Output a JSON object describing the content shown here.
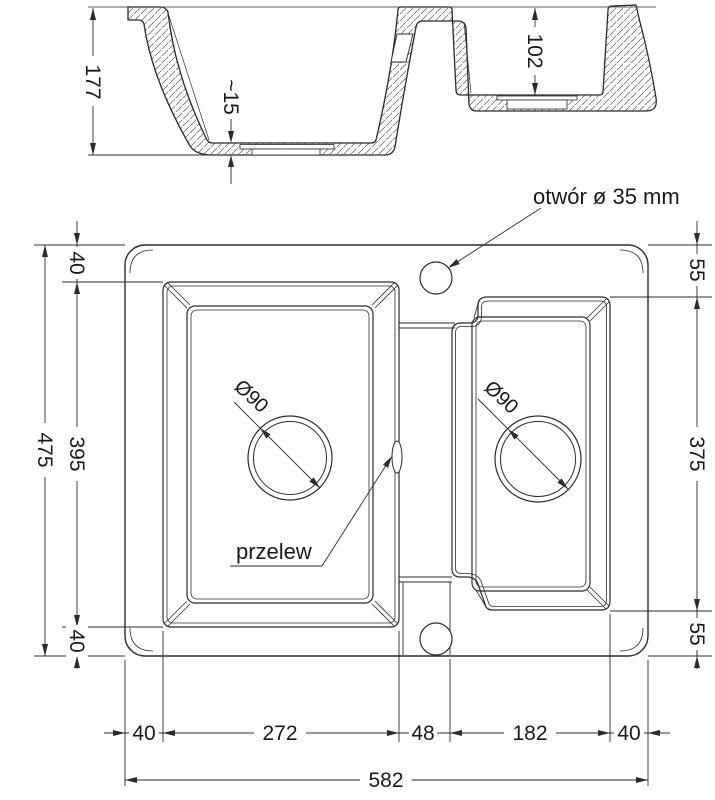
{
  "section_view": {
    "overall_depth": "177",
    "base_thickness": "~15",
    "small_bowl_depth": "102"
  },
  "plan_view": {
    "tap_hole_label": "otwór ø 35 mm",
    "overflow_label": "przelew",
    "drain_left": "Ø90",
    "drain_right": "Ø90"
  },
  "dimensions": {
    "left": {
      "top_margin": "40",
      "total_height": "475",
      "bowl_height": "395",
      "bottom_margin": "40"
    },
    "right": {
      "top_margin": "55",
      "bowl_height": "375",
      "bottom_margin": "55"
    },
    "bottom": {
      "left_margin": "40",
      "main_bowl_width": "272",
      "divider_width": "48",
      "small_bowl_width": "182",
      "right_margin": "40",
      "total_width": "582"
    }
  },
  "colors": {
    "line": "#2b2b2b",
    "background": "#ffffff"
  }
}
